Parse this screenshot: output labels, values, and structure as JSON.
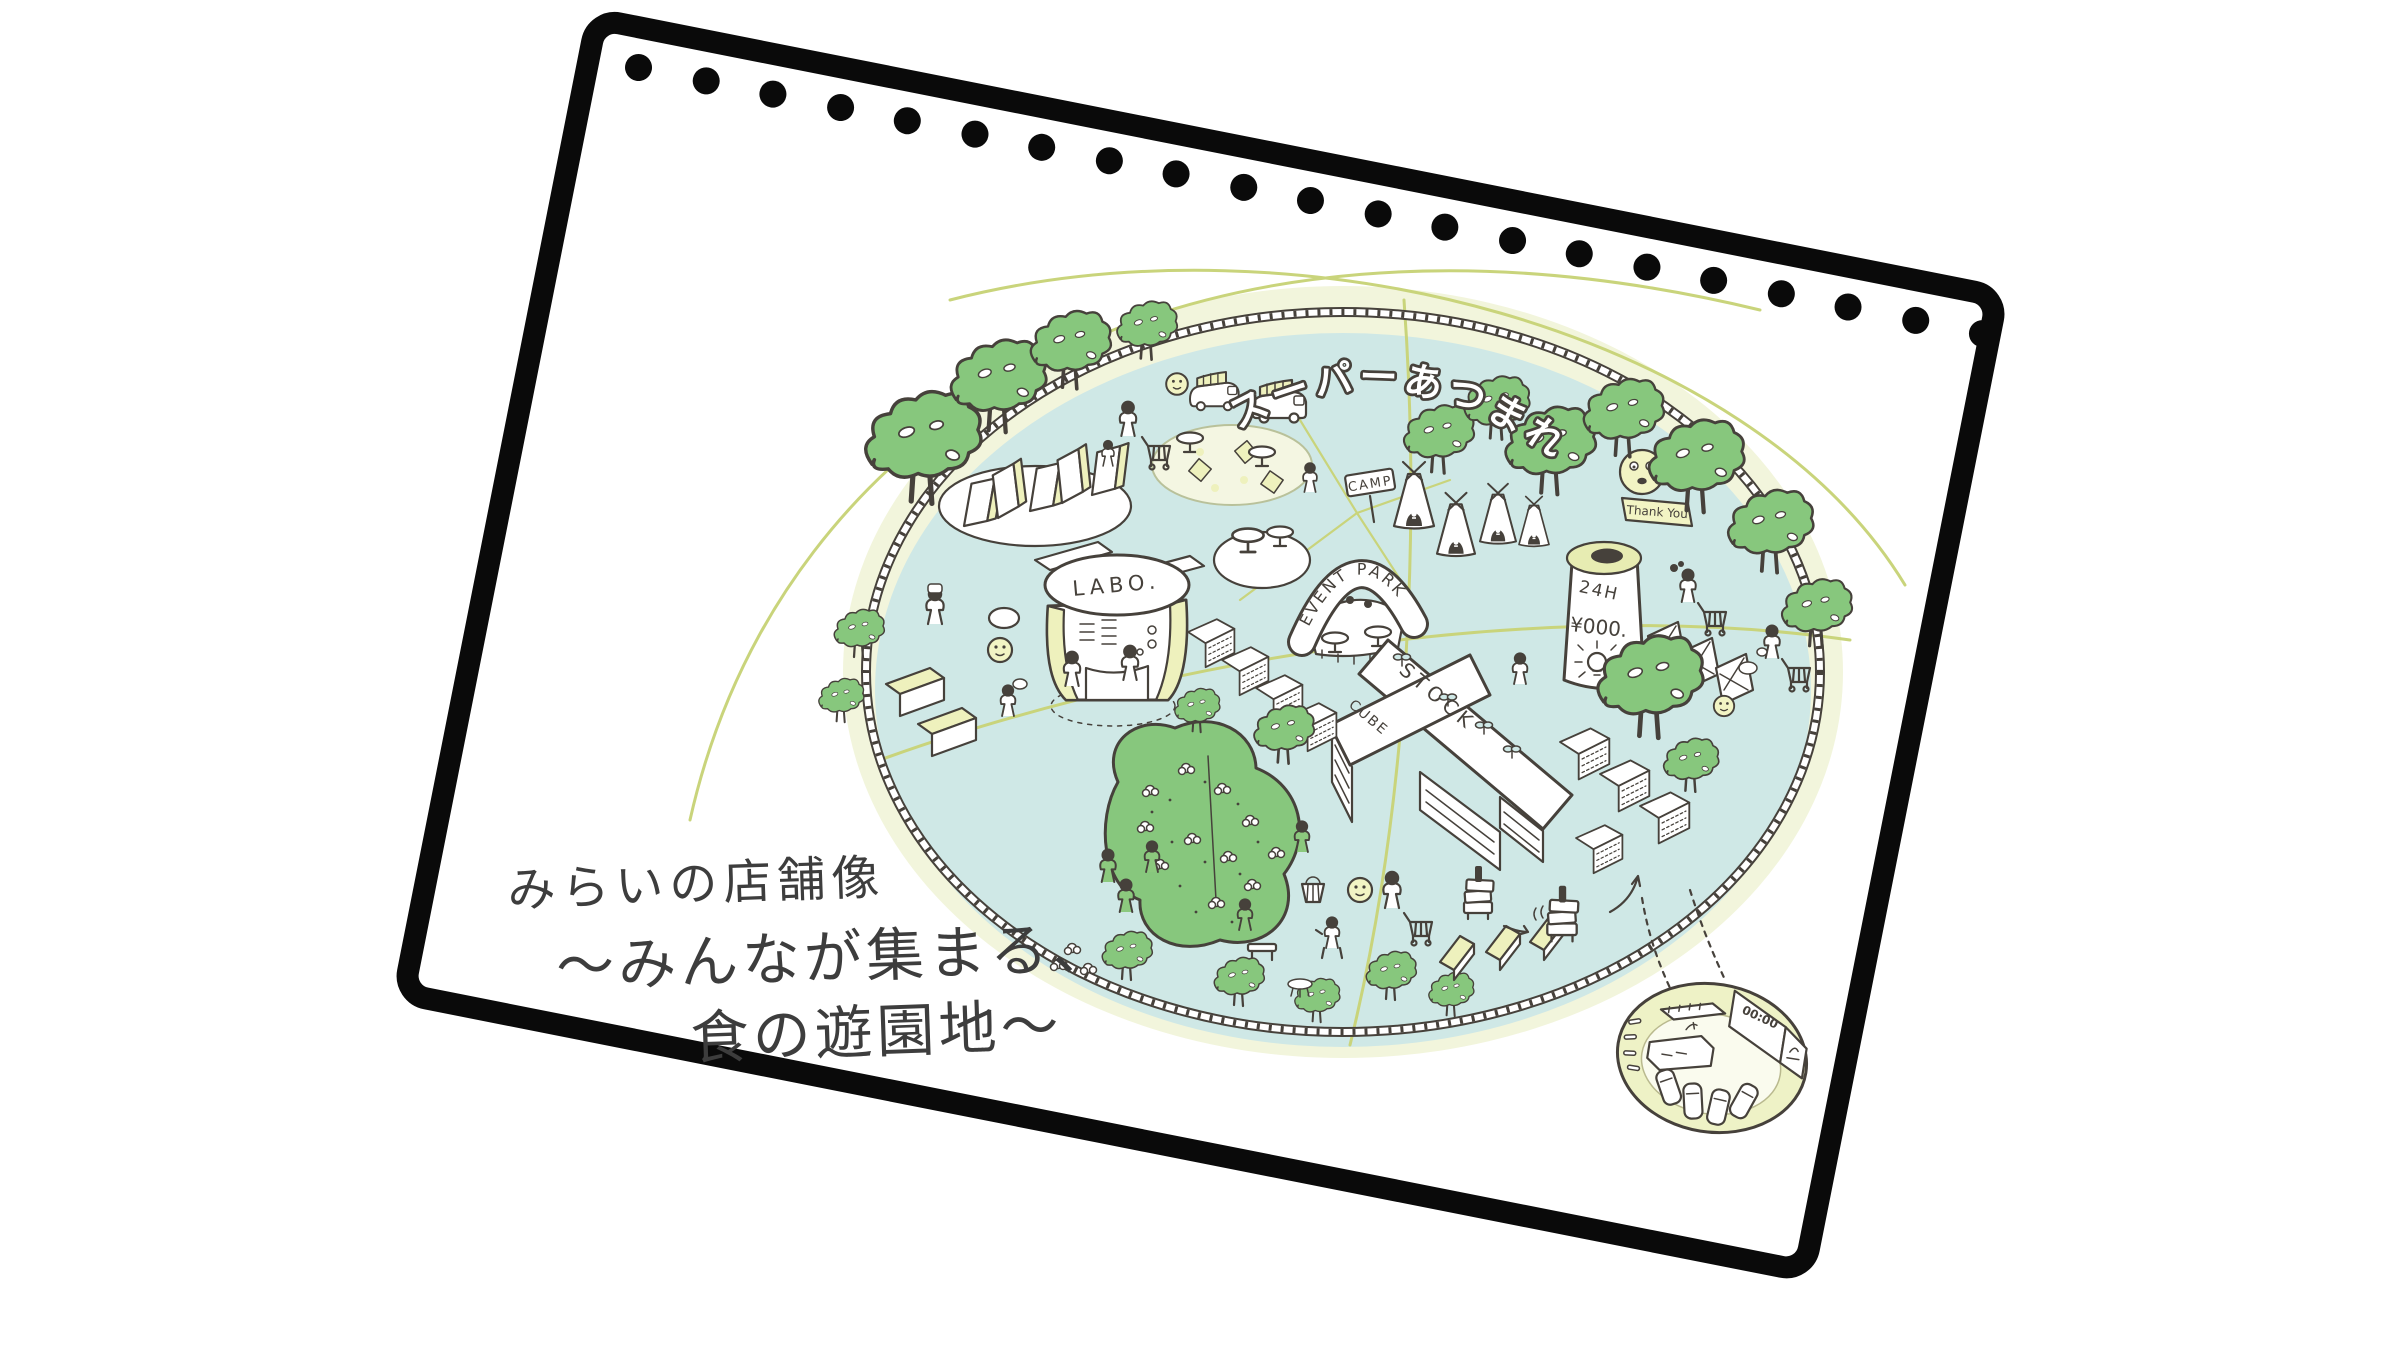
{
  "page": {
    "hole_count": 21
  },
  "illustration": {
    "banner": "スーパーあつまれ",
    "labels": {
      "event_park": "EVENT PARK",
      "camp": "CAMP",
      "labo": "LABO.",
      "stock": "STOCK",
      "cube": "CUBE",
      "open_hours": "24H",
      "price": "¥000.",
      "thank_you": "Thank You",
      "clock": "00:00"
    },
    "caption": {
      "line1": "みらいの店舗像",
      "line2": "〜みんなが集まる、",
      "line3": "食の遊園地〜"
    },
    "colors": {
      "frame_black": "#0a0a0a",
      "ink": "#46413b",
      "ground_blue": "#cfe8e6",
      "ring_cream": "#f2f5dc",
      "accent_yellow": "#eef1bd",
      "tree_green": "#87c77d",
      "path_olive": "#c9d47b"
    }
  }
}
